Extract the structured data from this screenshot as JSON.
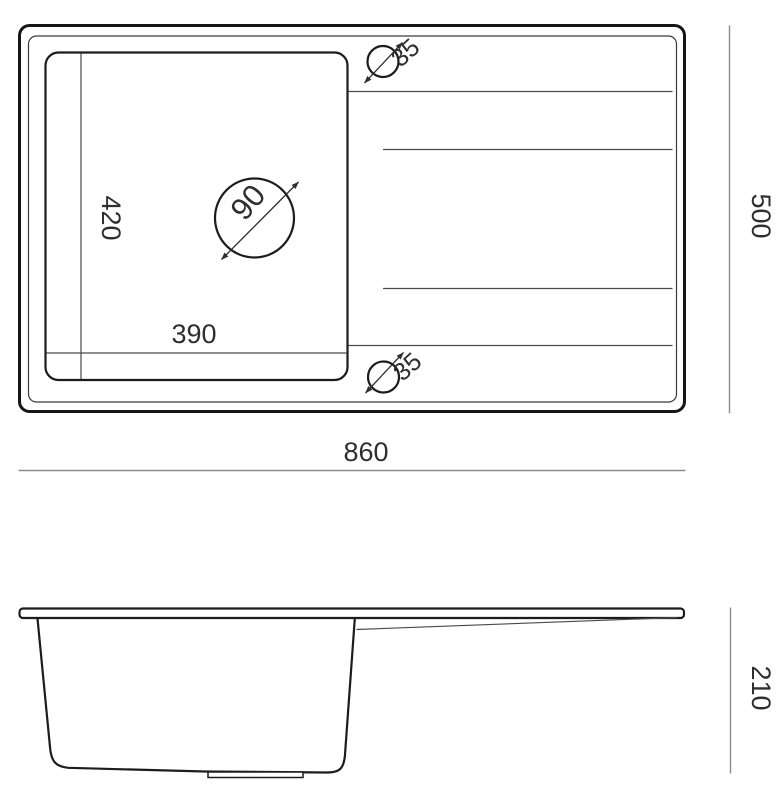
{
  "document": {
    "type": "technical-drawing",
    "subject": "kitchen sink with drainboard, top view and side view"
  },
  "colors": {
    "background": "#ffffff",
    "outline": "#161616",
    "thin_lines": "#4a4a4a",
    "dimension_lines": "#8c8c8c",
    "text": "#2f2f2f"
  },
  "top_view": {
    "bowl_depth_label": "420",
    "bowl_width_label": "390",
    "drain_diameter_label": "90",
    "faucet_hole_top_label": "35",
    "faucet_hole_bottom_label": "35",
    "overall_depth_label": "500",
    "overall_width_label": "860"
  },
  "side_view": {
    "height_label": "210"
  }
}
